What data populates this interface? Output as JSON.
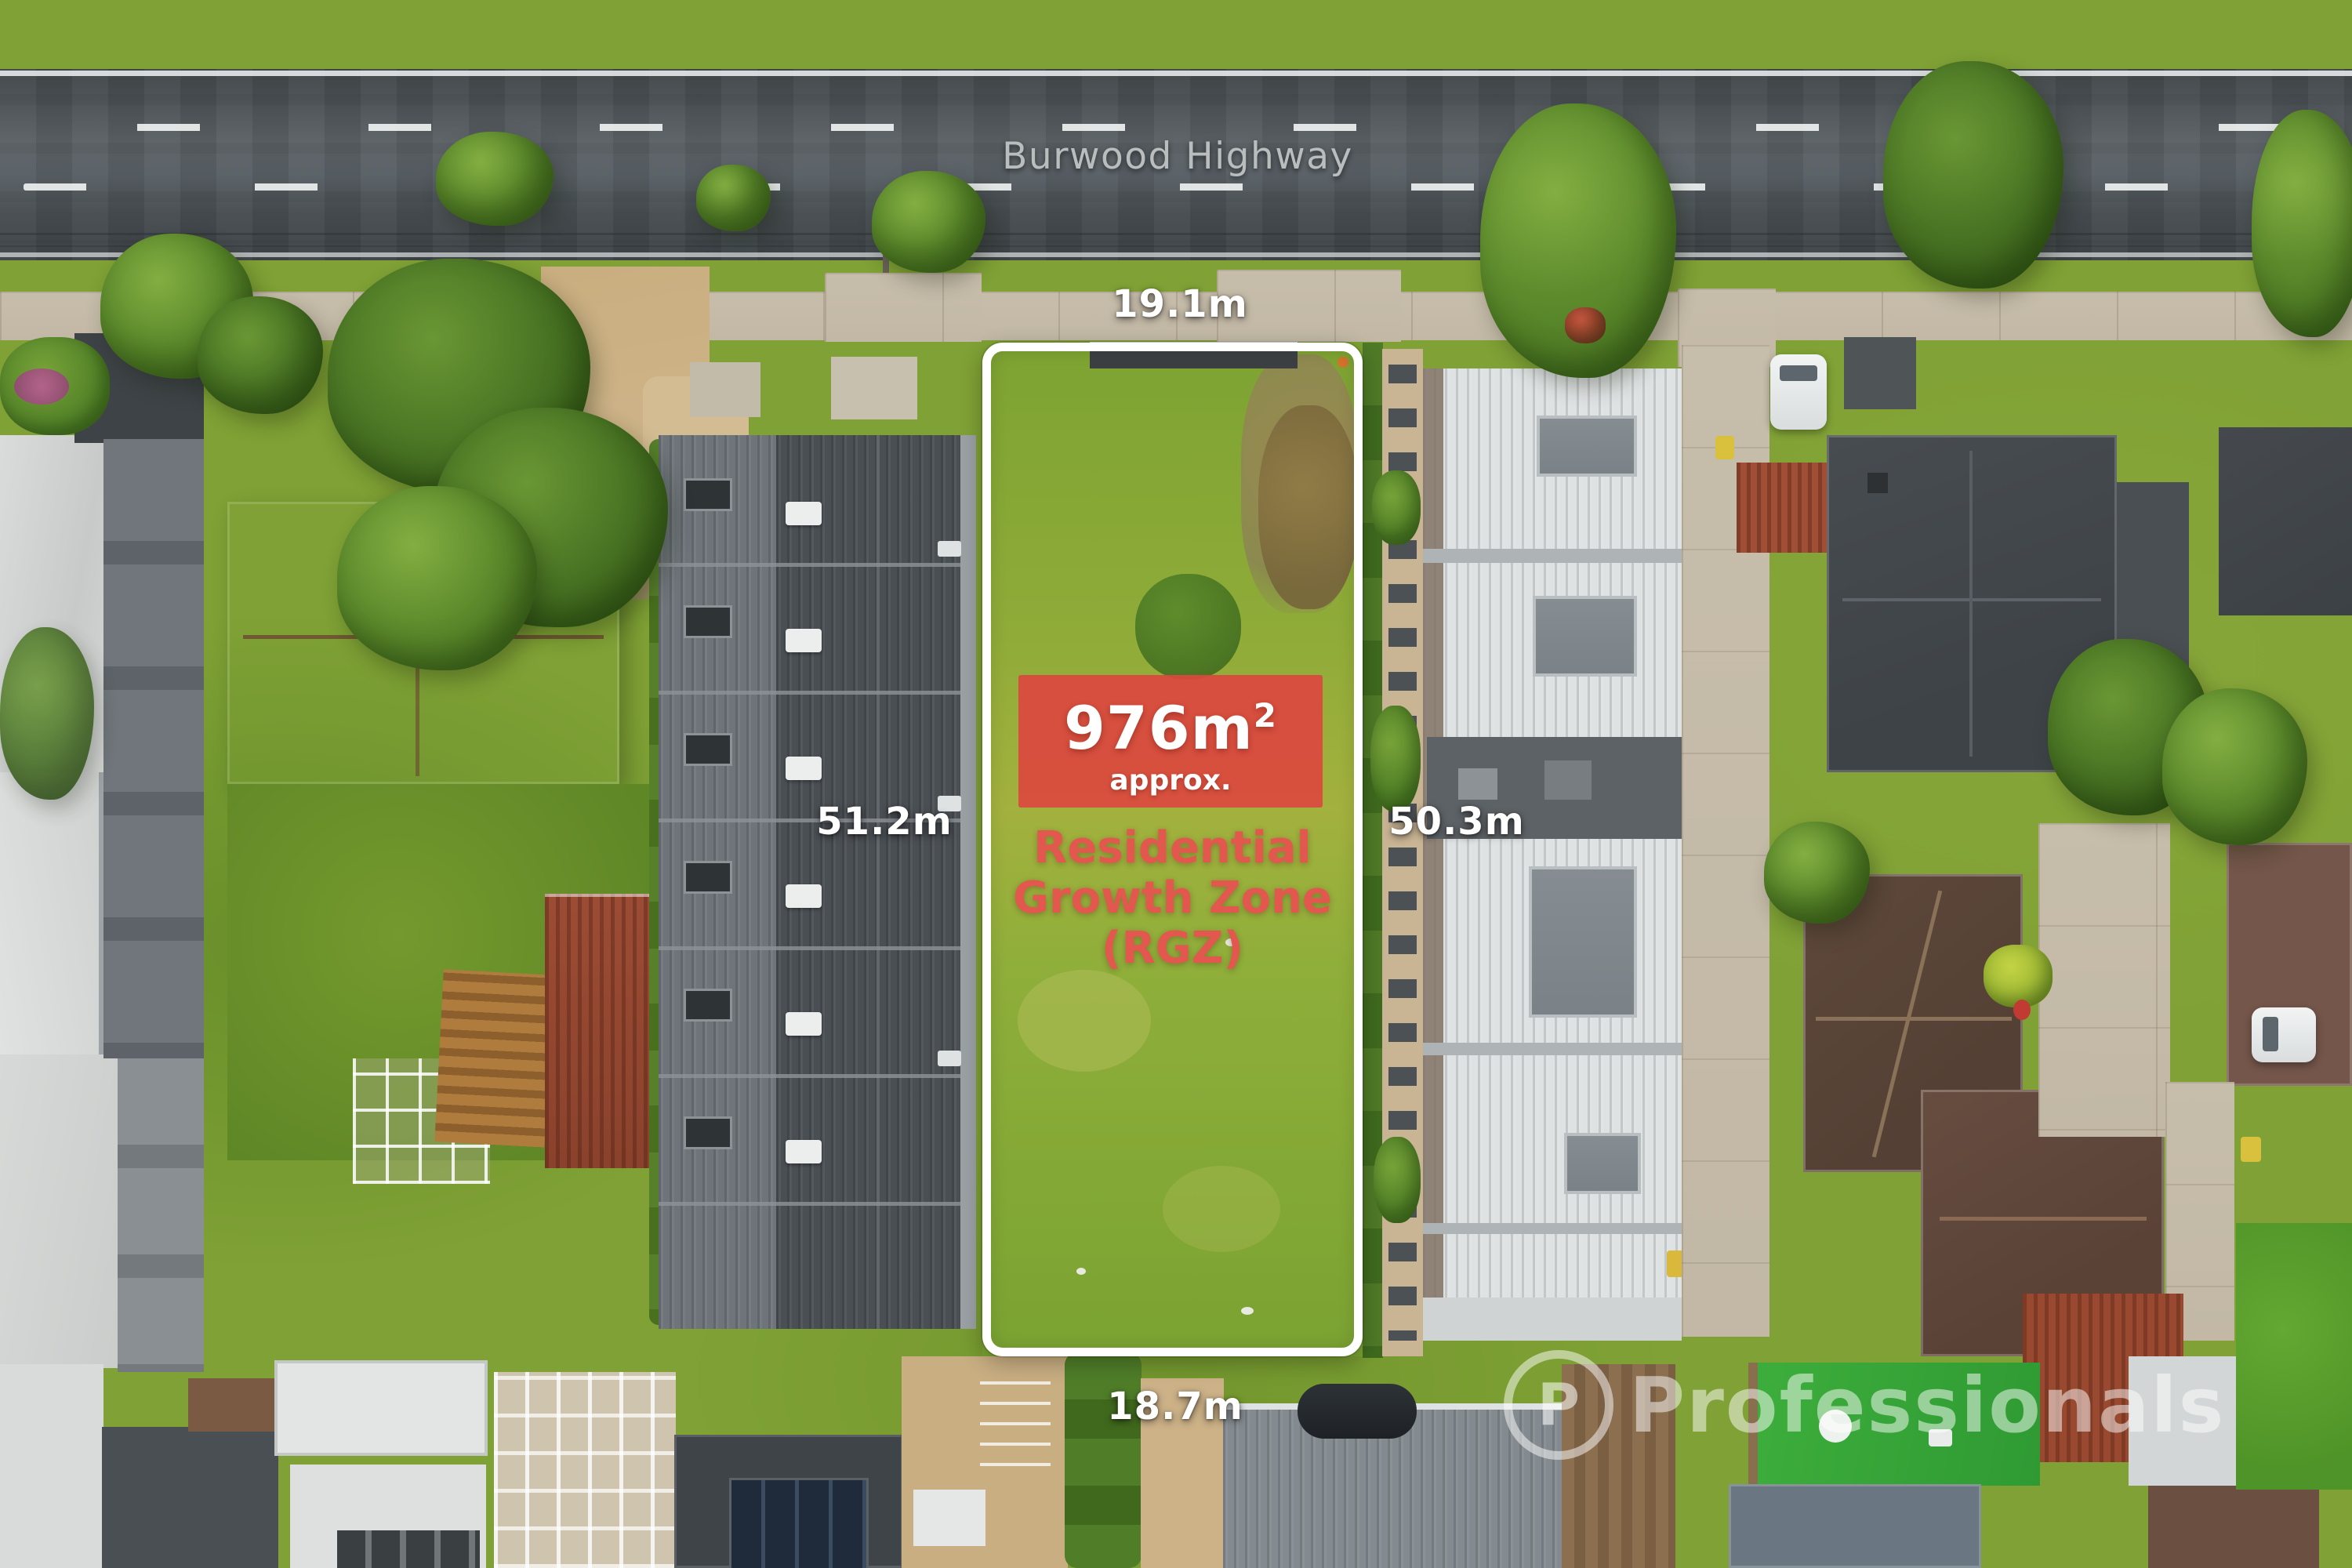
{
  "photo": {
    "street_label": "Burwood Highway",
    "dimensions": {
      "top": "19.1m",
      "left": "51.2m",
      "right": "50.3m",
      "bottom": "18.7m"
    },
    "area_badge": {
      "value": "976m",
      "superscript": "2",
      "qualifier": "approx."
    },
    "zone_label": {
      "line1": "Residential",
      "line2": "Growth Zone",
      "line3": "(RGZ)"
    },
    "watermark": {
      "logo_letter": "P",
      "text": "Professionals"
    },
    "colors": {
      "badge_red": "#DB483E",
      "zone_red": "#E2584E",
      "label_white": "#FFFFFF",
      "boundary_white": "#FFFFFF",
      "road_asphalt": "#4C5256",
      "grass_green": "#7FA135"
    }
  }
}
